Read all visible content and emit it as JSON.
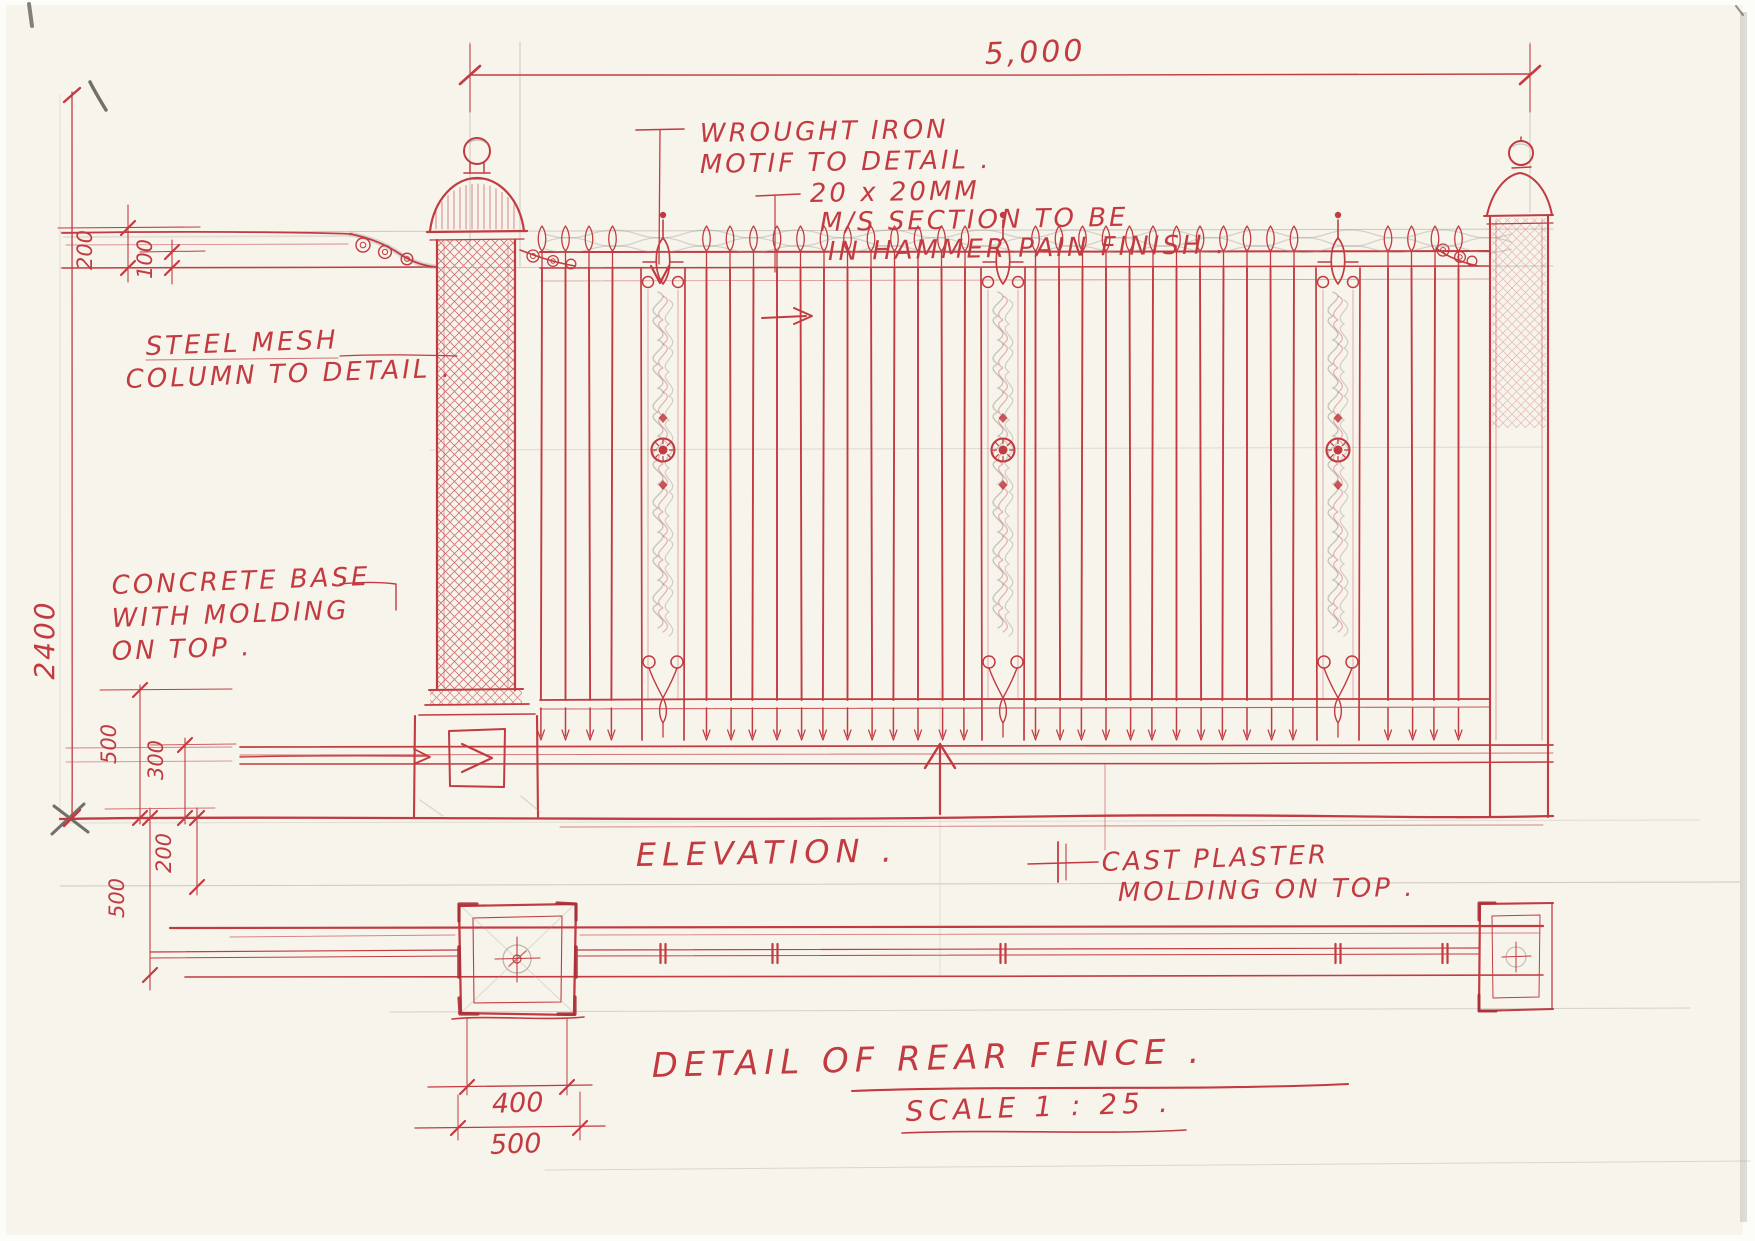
{
  "drawing": {
    "elevation_label": "ELEVATION .",
    "title": "DETAIL OF REAR FENCE .",
    "scale": "SCALE 1 : 25 ."
  },
  "annotations": {
    "wrought_iron": {
      "lines": [
        "WROUGHT IRON",
        "MOTIF TO DETAIL ."
      ]
    },
    "ms_section": {
      "lines": [
        "20 x 20MM",
        "M/S SECTION TO BE",
        "IN HAMMER PAIN FINISH ."
      ]
    },
    "steel_mesh": {
      "lines": [
        "STEEL MESH",
        "COLUMN TO DETAIL ."
      ]
    },
    "concrete_base": {
      "lines": [
        "CONCRETE BASE",
        "WITH MOLDING",
        "ON TOP ."
      ]
    },
    "cast_plaster": {
      "lines": [
        "CAST PLASTER",
        "MOLDING ON TOP ."
      ]
    }
  },
  "dimensions": {
    "overall_width": "5,000",
    "overall_height": "2400",
    "top_rail_offset": "200",
    "top_rail_inner_offset": "100",
    "base_height": "500",
    "plinth_height": "300",
    "plan_fence_depth": "500",
    "plan_wall_depth": "200",
    "column_plan_width": "400",
    "column_plan_base_width": "500"
  },
  "colors": {
    "ink_red": "#c23b41",
    "pencil_gray": "#a19d94",
    "paper": "#f7f4ec"
  }
}
